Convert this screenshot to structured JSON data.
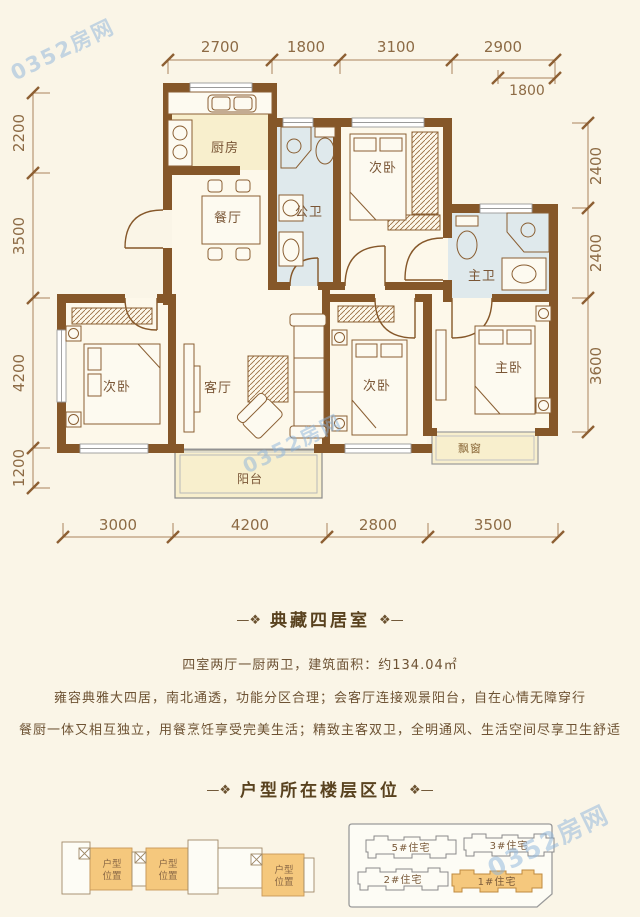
{
  "watermark": {
    "text": "0352房网"
  },
  "floorplan": {
    "rooms": {
      "kitchen": "厨房",
      "dining": "餐厅",
      "bath_public": "公卫",
      "bed_top": "次卧",
      "bath_master": "主卫",
      "bed_left": "次卧",
      "living": "客厅",
      "bed_mid": "次卧",
      "bed_master": "主卧",
      "balcony": "阳台",
      "bay_window": "飘窗"
    },
    "dims_top": [
      "2700",
      "1800",
      "3100",
      "2900"
    ],
    "dim_top_sub": "1800",
    "dims_left": [
      "2200",
      "3500",
      "4200",
      "1200"
    ],
    "dims_right": [
      "2400",
      "2400",
      "3600"
    ],
    "dims_bottom": [
      "3000",
      "4200",
      "2800",
      "3500"
    ]
  },
  "unit_section": {
    "ornament_left": "—❖",
    "ornament_right": "❖—",
    "title": "典藏四居室",
    "summary": "四室两厅一厨两卫，建筑面积：约134.04㎡",
    "desc_line1": "雍容典雅大四居，南北通透，功能分区合理；会客厅连接观景阳台，自在心情无障穿行",
    "desc_line2": "餐厨一体又相互独立，用餐烹饪享受完美生活；精致主客双卫，全明通风、生活空间尽享卫生舒适"
  },
  "location_section": {
    "title": "户型所在楼层区位",
    "unit_marker_line1": "户型",
    "unit_marker_line2": "位置",
    "buildings": [
      "5#住宅",
      "3#住宅",
      "2#住宅",
      "1#住宅"
    ]
  }
}
